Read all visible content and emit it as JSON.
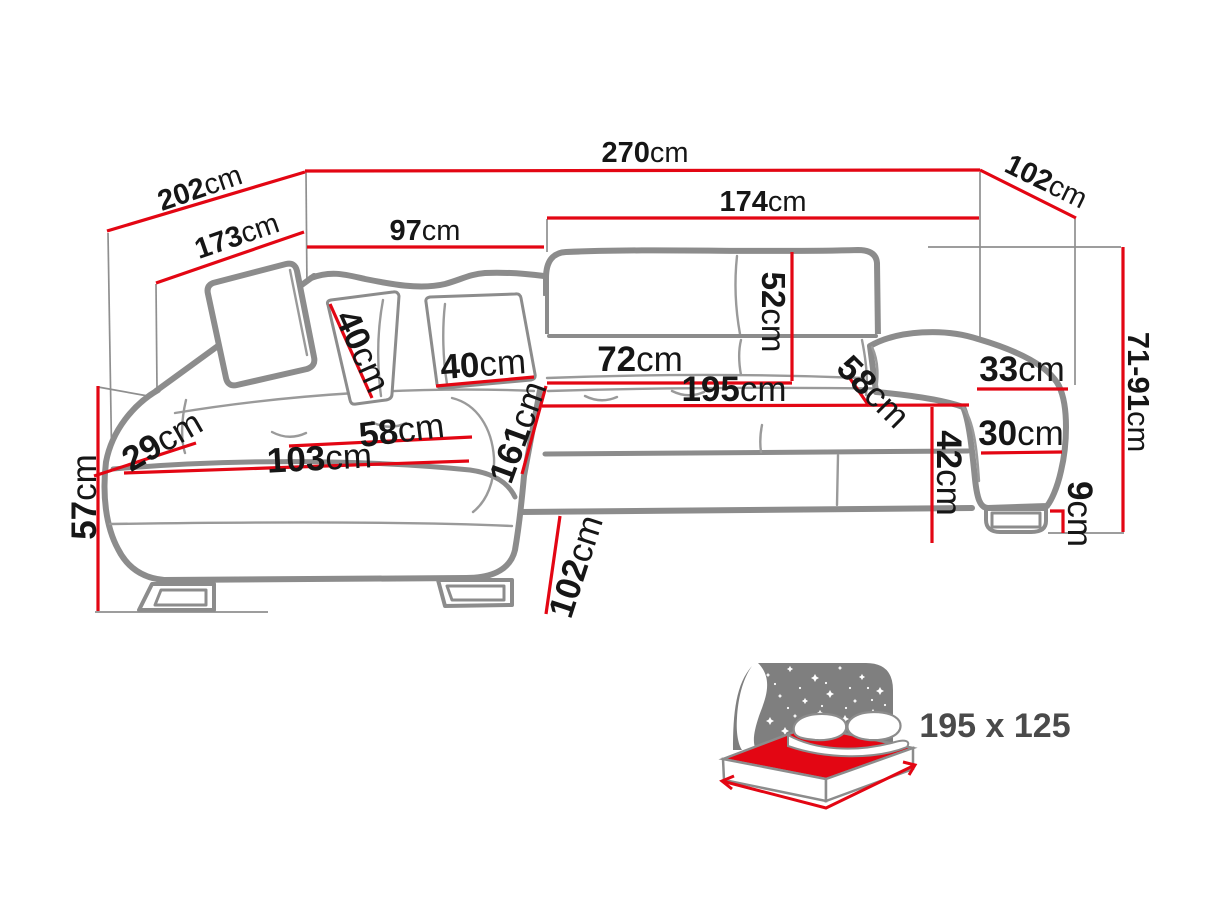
{
  "title": "Corner sofa bed dimensions diagram",
  "colors": {
    "dimension_line": "#e30613",
    "sofa_outline": "#8c8c8c",
    "extension_line": "#8f8f8f",
    "label_text": "#161616",
    "bed_icon_gray": "#7f7f7f",
    "bed_mattress_red": "#e30613",
    "bed_size_text": "#4a4a4a"
  },
  "diagram": {
    "unit": "cm",
    "dimensions": [
      {
        "id": "total-width",
        "value": "270",
        "unit": "cm"
      },
      {
        "id": "depth-top-right",
        "value": "102",
        "unit": "cm"
      },
      {
        "id": "diagonal-outer-left",
        "value": "202",
        "unit": "cm"
      },
      {
        "id": "diagonal-inner-left",
        "value": "173",
        "unit": "cm"
      },
      {
        "id": "back-section-width",
        "value": "97",
        "unit": "cm"
      },
      {
        "id": "seat-width-total",
        "value": "174",
        "unit": "cm"
      },
      {
        "id": "backrest-height",
        "value": "52",
        "unit": "cm"
      },
      {
        "id": "pillow-left",
        "value": "40",
        "unit": "cm"
      },
      {
        "id": "pillow-right",
        "value": "40",
        "unit": "cm"
      },
      {
        "id": "seat-depth-right",
        "value": "72",
        "unit": "cm"
      },
      {
        "id": "sleeping-length",
        "value": "195",
        "unit": "cm"
      },
      {
        "id": "seat-diagonal-right",
        "value": "58",
        "unit": "cm"
      },
      {
        "id": "armrest-top-width",
        "value": "33",
        "unit": "cm"
      },
      {
        "id": "armrest-front-width",
        "value": "30",
        "unit": "cm"
      },
      {
        "id": "seat-front-height",
        "value": "42",
        "unit": "cm"
      },
      {
        "id": "leg-height",
        "value": "9",
        "unit": "cm"
      },
      {
        "id": "total-height",
        "value": "71-91",
        "unit": "cm"
      },
      {
        "id": "chaise-seat-width",
        "value": "58",
        "unit": "cm"
      },
      {
        "id": "chaise-front-width",
        "value": "103",
        "unit": "cm"
      },
      {
        "id": "chaise-back-offset",
        "value": "29",
        "unit": "cm"
      },
      {
        "id": "chaise-length",
        "value": "161",
        "unit": "cm"
      },
      {
        "id": "chaise-total-depth",
        "value": "102",
        "unit": "cm"
      },
      {
        "id": "side-height",
        "value": "57",
        "unit": "cm"
      }
    ],
    "bed_icon": {
      "size_label": "195 x 125"
    }
  }
}
